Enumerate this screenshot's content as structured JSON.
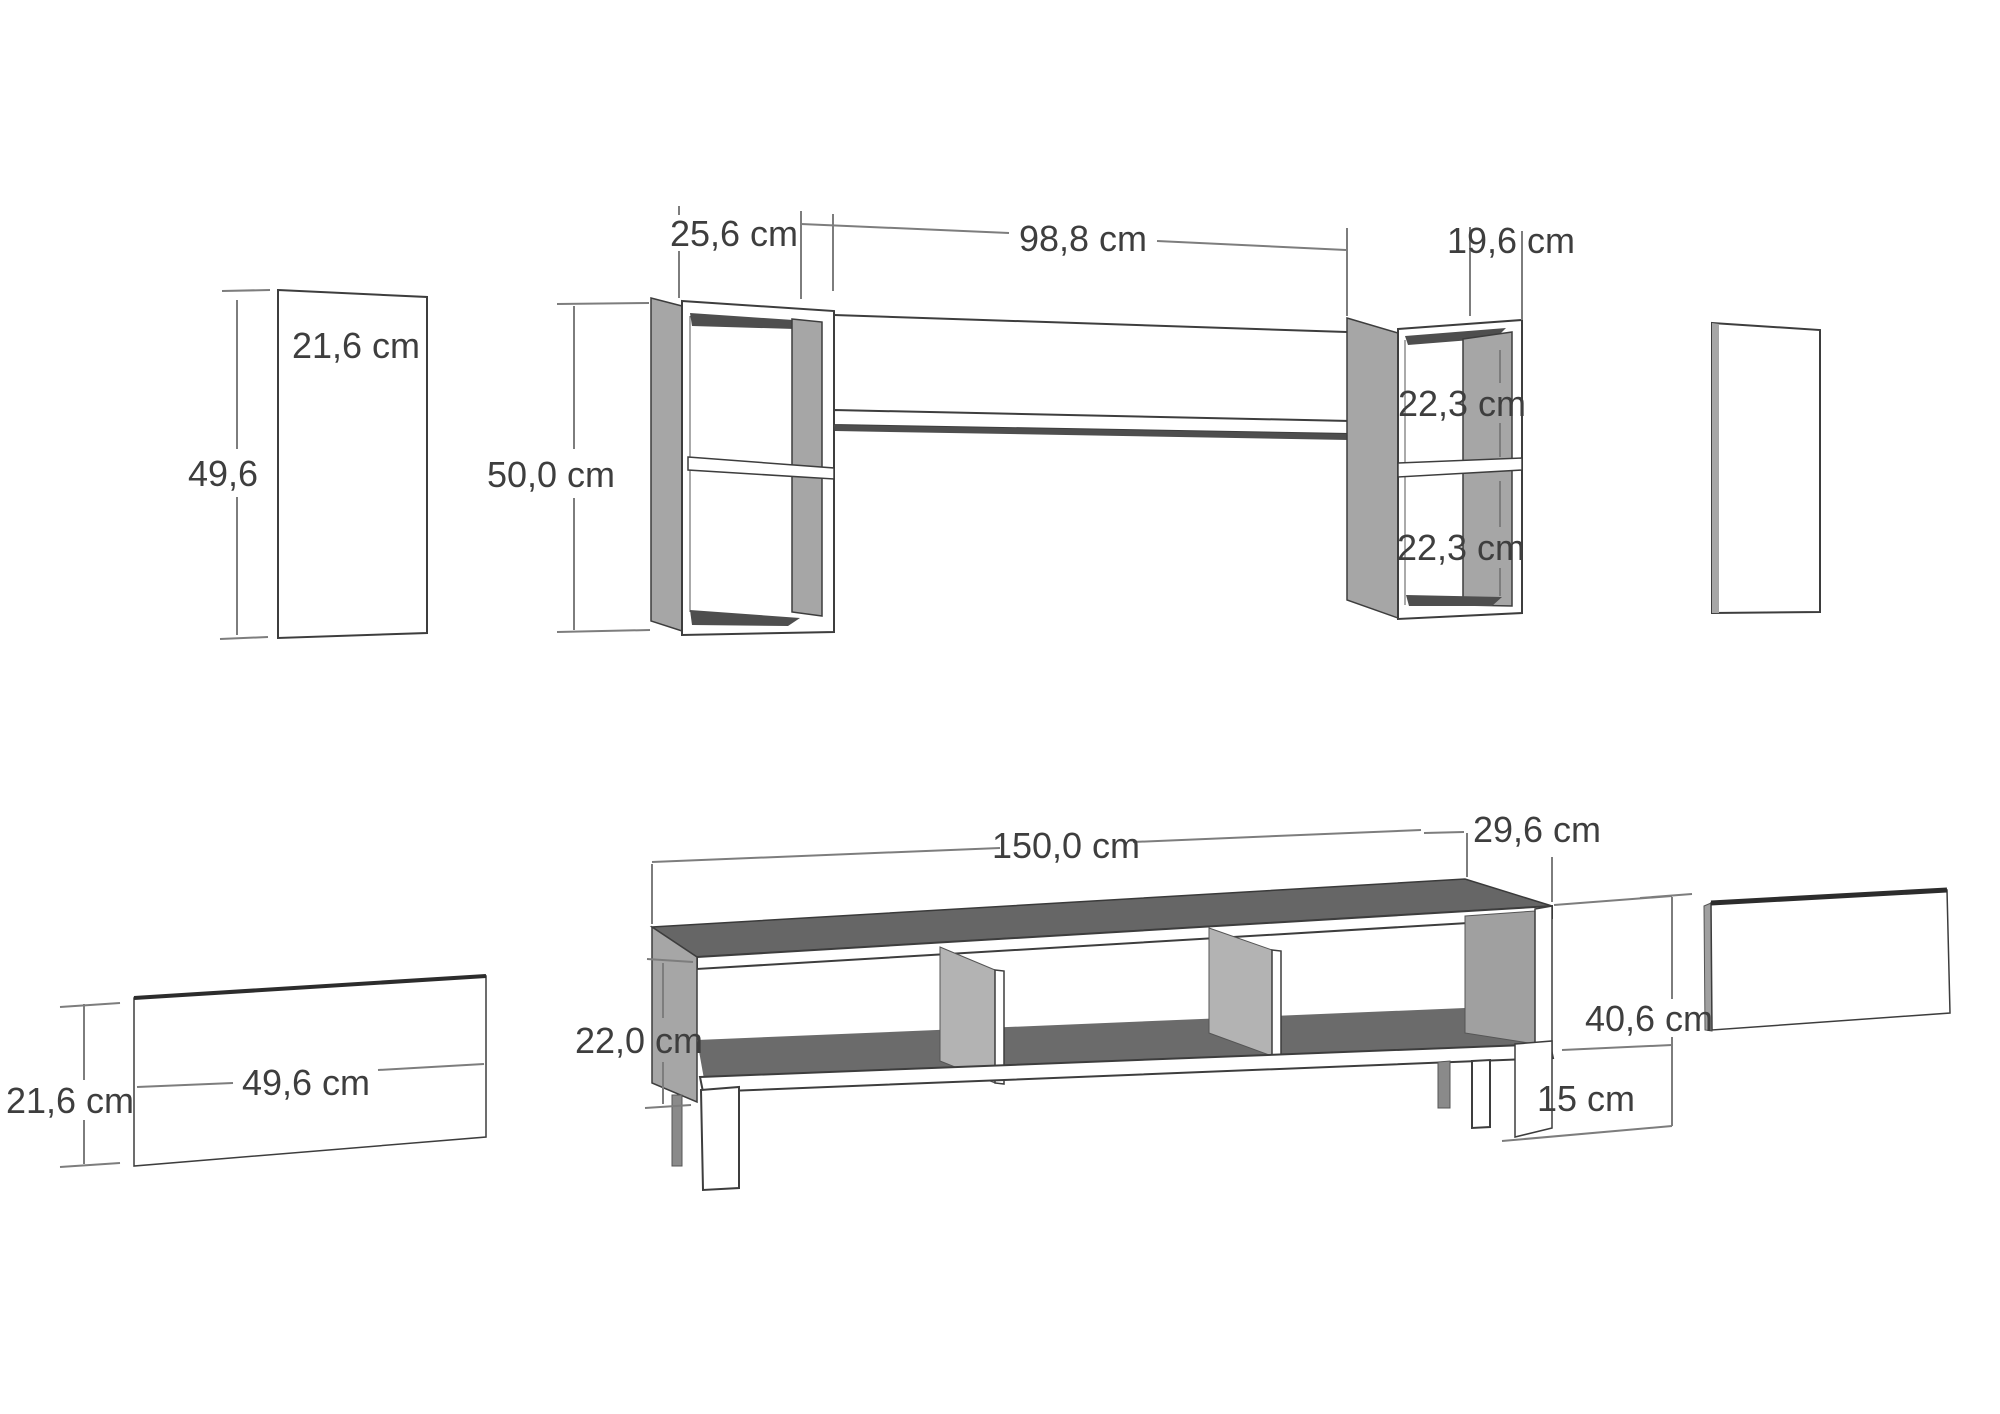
{
  "document": {
    "type": "furniture-dimension-diagram",
    "background": "#ffffff",
    "line_color": "#7d7d7d",
    "outline_color": "#3d3d3d",
    "panel_grey": "#a6a6a6",
    "dark_face_grey": "#666666",
    "text_color": "#3e3e3e"
  },
  "measurements": {
    "wall_panel_width": "21,6 cm",
    "wall_panel_height": "49,6",
    "wall_box_left_depth": "25,6 cm",
    "wall_shelf_span": "98,8 cm",
    "wall_box_right_depth": "19,6 cm",
    "wall_box_height": "50,0 cm",
    "wall_box_right_upper": "22,3 cm",
    "wall_box_right_lower": "22,3 cm",
    "stand_width": "150,0 cm",
    "stand_depth": "29,6 cm",
    "stand_opening_height": "22,0 cm",
    "stand_height": "40,6 cm",
    "stand_leg_height": "15 cm",
    "stand_panel_width": "49,6 cm",
    "stand_panel_height": "21,6 cm"
  }
}
